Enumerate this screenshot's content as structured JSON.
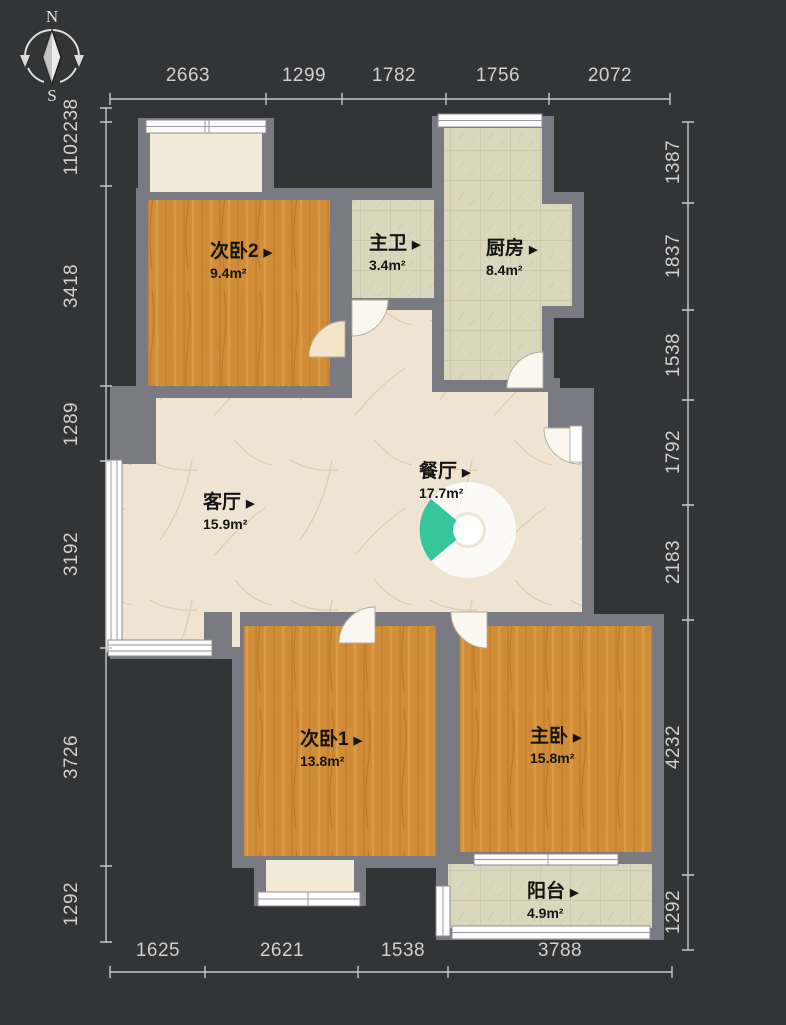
{
  "compass": {
    "north": "N",
    "south": "S"
  },
  "dimensions": {
    "top": [
      "2663",
      "1299",
      "1782",
      "1756",
      "2072"
    ],
    "bottom": [
      "1625",
      "2621",
      "1538",
      "3788"
    ],
    "left": [
      "238",
      "1102",
      "3418",
      "1289",
      "3192",
      "3726",
      "1292"
    ],
    "right": [
      "1387",
      "1837",
      "1538",
      "1792",
      "2183",
      "4232",
      "1292"
    ]
  },
  "rooms": [
    {
      "id": "bedroom2",
      "name": "次卧2",
      "area": "9.4m²"
    },
    {
      "id": "bathroom",
      "name": "主卫",
      "area": "3.4m²"
    },
    {
      "id": "kitchen",
      "name": "厨房",
      "area": "8.4m²"
    },
    {
      "id": "living",
      "name": "客厅",
      "area": "15.9m²"
    },
    {
      "id": "dining",
      "name": "餐厅",
      "area": "17.7m²"
    },
    {
      "id": "bedroom1",
      "name": "次卧1",
      "area": "13.8m²"
    },
    {
      "id": "master",
      "name": "主卧",
      "area": "15.8m²"
    },
    {
      "id": "balcony",
      "name": "阳台",
      "area": "4.9m²"
    }
  ],
  "ui": {
    "room_marker": "▶"
  },
  "colors": {
    "background": "#333436",
    "wall": "#7a7a82",
    "wood_floor": "#d18c38",
    "tile_floor": "#dbd7bc",
    "marble_floor": "#eee4d1",
    "bay_floor": "#f4ead8",
    "camera_accent": "#36c69b",
    "dimension_text": "#d0d0d0"
  }
}
